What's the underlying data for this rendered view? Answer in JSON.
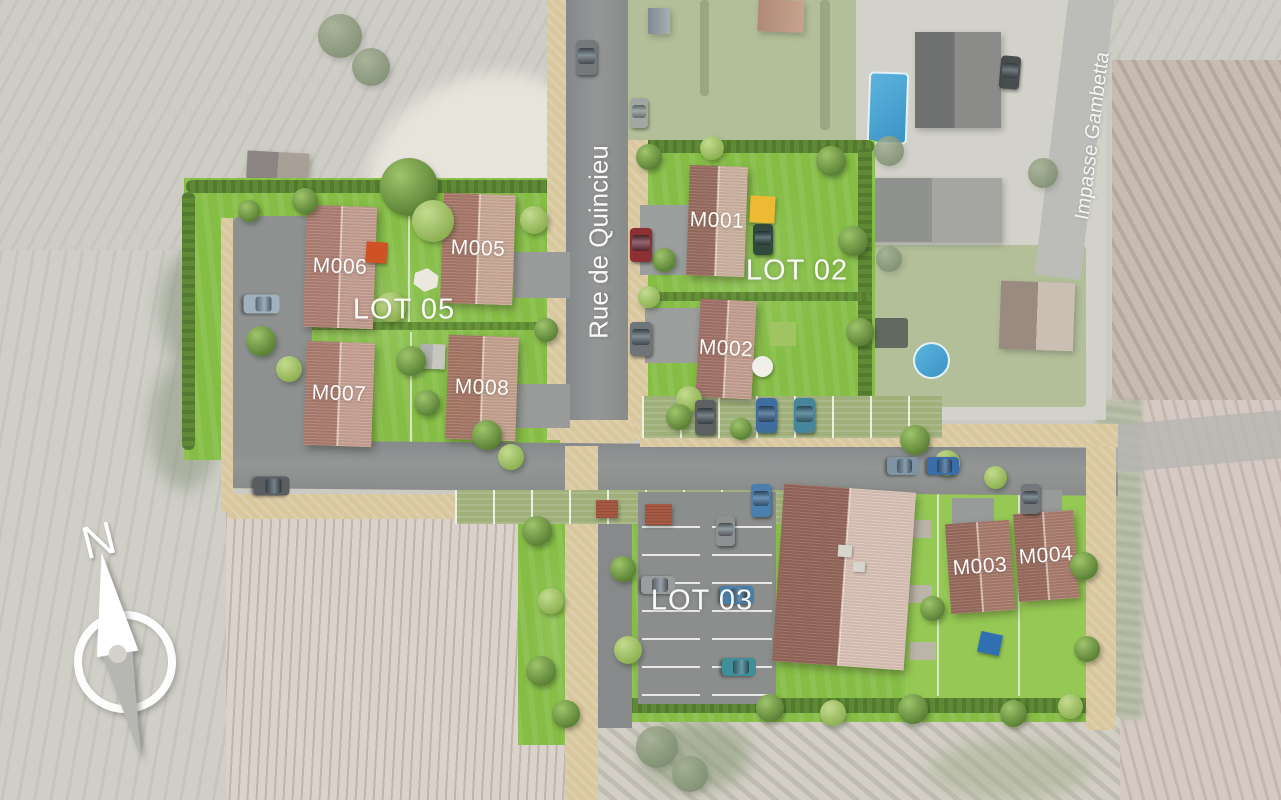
{
  "plan": {
    "title": "residential-development-aerial-site-plan",
    "streets": {
      "main": "Rue de Quincieu",
      "side": "Impasse Gambetta"
    },
    "lots": {
      "lot05": "LOT 05",
      "lot02": "LOT 02",
      "lot03": "LOT 03"
    },
    "buildings": {
      "m001": "M001",
      "m002": "M002",
      "m003": "M003",
      "m004": "M004",
      "m005": "M005",
      "m006": "M006",
      "m007": "M007",
      "m008": "M008"
    },
    "compass": {
      "north": "N"
    },
    "colors": {
      "lawn": "#85bd45",
      "roof_dark": "#9a6c5e",
      "roof_light": "#cdae9e",
      "road": "#8f9291",
      "path": "#d9c79e",
      "pool_blue": "#4aa6d6",
      "accent_orange": "#cf5126",
      "accent_yellow": "#ecba33",
      "label_text": "#ffffff"
    }
  }
}
